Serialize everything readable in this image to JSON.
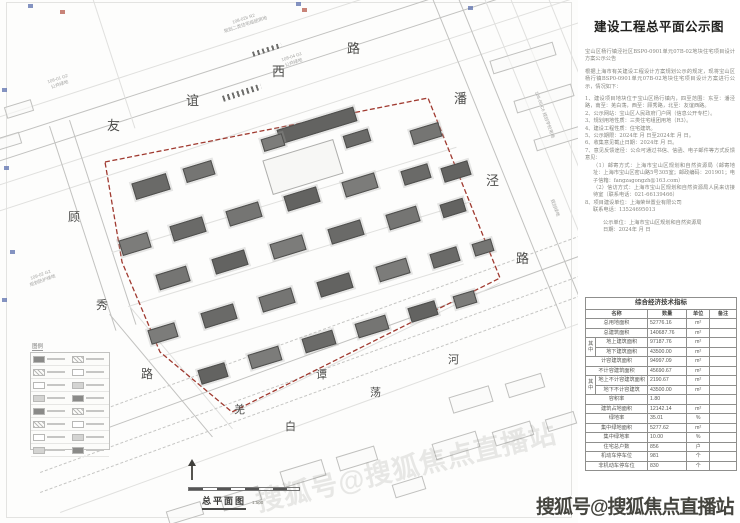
{
  "watermark": {
    "text": "搜狐号@搜狐焦点直播站",
    "ghost_text": "搜狐号@搜狐焦点直播站"
  },
  "panel": {
    "title": "建设工程总平面公示图",
    "paragraphs": [
      {
        "t": "宝山区杨行镇泾社区BSP0-0901单元07B-02地块住宅项目设计方案公示公告",
        "c": "p gap"
      },
      {
        "t": "根据上海市有关建设工程设计方案规划公示的规定，现将宝山区杨行镇BSP0-0901单元07B-02地块住宅项目设计方案进行公示，情况如下：",
        "c": "p gap"
      },
      {
        "t": "1、建设项目地块位于宝山区杨行镇内，四至范围：东至：潘泾路，南至：羌白荡，西至：顾秀路，北至：友谊西路。",
        "c": "p gap"
      },
      {
        "t": "2、公示网站：宝山区人民政府门户网（信息公开专栏）。",
        "c": "p"
      },
      {
        "t": "3、规划用地性质：三类住宅组团用地（R3）。",
        "c": "p"
      },
      {
        "t": "4、建设工程性质：住宅建筑。",
        "c": "p"
      },
      {
        "t": "5、公示期限：2024年 月 日至2024年 月 日。",
        "c": "p"
      },
      {
        "t": "6、收集意见截止日期：2024年 月 日。",
        "c": "p"
      },
      {
        "t": "7、意见反馈途径：公众可通过书信、信函、电子邮件等方式反馈意见：",
        "c": "p"
      },
      {
        "t": "（1）邮寄方式：上海市宝山区规划和自然资源局（邮寄地址：上海市宝山区密山路5号305室；邮政编码：201901；电子信箱：fangzagongzh@163.com）",
        "c": "p ind"
      },
      {
        "t": "（2）信访方式：上海市宝山区规划和自然资源局人民来访接待室（联系电话：021-66139466）",
        "c": "p ind"
      },
      {
        "t": "8、项目建设单位：上海荣世置业有限公司",
        "c": "p"
      },
      {
        "t": "联系电话：13524695013",
        "c": "p ind"
      },
      {
        "t": "公示单位：上海市宝山区规划和自然资源局",
        "c": "p ind2 gap"
      },
      {
        "t": "日期：2024年 月 日",
        "c": "p ind2"
      }
    ],
    "table": {
      "title": "综合经济技术指标",
      "headers": [
        "名称",
        "数量",
        "单位",
        "备注"
      ],
      "group_label": "其中",
      "rows": [
        {
          "name": "总用地面积",
          "value": "52776.16",
          "unit": "m²",
          "note": "",
          "flag": ""
        },
        {
          "name": "总建筑面积",
          "value": "140687.76",
          "unit": "m²",
          "note": "",
          "flag": ""
        },
        {
          "name": "地上建筑面积",
          "value": "97187.76",
          "unit": "m²",
          "note": "",
          "flag": "gs"
        },
        {
          "name": "地下建筑面积",
          "value": "43500.00",
          "unit": "m²",
          "note": "",
          "flag": "gm"
        },
        {
          "name": "计容建筑面积",
          "value": "94997.09",
          "unit": "m²",
          "note": "",
          "flag": ""
        },
        {
          "name": "不计容建筑面积",
          "value": "45690.67",
          "unit": "m²",
          "note": "",
          "flag": ""
        },
        {
          "name": "地上不计容建筑面积",
          "value": "2190.67",
          "unit": "m²",
          "note": "",
          "flag": "gs"
        },
        {
          "name": "地下不计容建筑",
          "value": "43500.00",
          "unit": "m²",
          "note": "",
          "flag": "gm"
        },
        {
          "name": "容积率",
          "value": "1.80",
          "unit": "",
          "note": "",
          "flag": ""
        },
        {
          "name": "建筑占地面积",
          "value": "12142.14",
          "unit": "m²",
          "note": "",
          "flag": ""
        },
        {
          "name": "绿地率",
          "value": "35.01",
          "unit": "%",
          "note": "",
          "flag": ""
        },
        {
          "name": "集中绿地面积",
          "value": "5277.62",
          "unit": "m²",
          "note": "",
          "flag": ""
        },
        {
          "name": "集中绿地率",
          "value": "10.00",
          "unit": "%",
          "note": "",
          "flag": ""
        },
        {
          "name": "住宅总户数",
          "value": "856",
          "unit": "户",
          "note": "",
          "flag": ""
        },
        {
          "name": "机动车停车位",
          "value": "981",
          "unit": "个",
          "note": "",
          "flag": ""
        },
        {
          "name": "非机动车停车位",
          "value": "830",
          "unit": "个",
          "note": "",
          "flag": ""
        }
      ]
    }
  },
  "map": {
    "plan_label": "总平面图",
    "scale_label": "1:500",
    "legend_title": "图例",
    "legend_row_count": 8,
    "boundary_color": "#a03a30",
    "boundary_points": "105,162 428,98 500,278 232,412 160,352 122,262",
    "road_labels": [
      {
        "ch": "友",
        "x": 107,
        "y": 115,
        "s": 13
      },
      {
        "ch": "谊",
        "x": 186,
        "y": 90,
        "s": 13
      },
      {
        "ch": "西",
        "x": 272,
        "y": 61,
        "s": 13
      },
      {
        "ch": "路",
        "x": 347,
        "y": 38,
        "s": 13
      },
      {
        "ch": "潘",
        "x": 454,
        "y": 88,
        "s": 13
      },
      {
        "ch": "泾",
        "x": 486,
        "y": 170,
        "s": 13
      },
      {
        "ch": "路",
        "x": 516,
        "y": 248,
        "s": 13
      },
      {
        "ch": "顾",
        "x": 68,
        "y": 208,
        "s": 12
      },
      {
        "ch": "秀",
        "x": 96,
        "y": 296,
        "s": 12
      },
      {
        "ch": "路",
        "x": 141,
        "y": 365,
        "s": 12
      },
      {
        "ch": "羌",
        "x": 234,
        "y": 401,
        "s": 11
      },
      {
        "ch": "白",
        "x": 285,
        "y": 418,
        "s": 11
      },
      {
        "ch": "谭",
        "x": 316,
        "y": 366,
        "s": 11
      },
      {
        "ch": "荡",
        "x": 370,
        "y": 384,
        "s": 11
      },
      {
        "ch": "河",
        "x": 448,
        "y": 351,
        "s": 11
      }
    ],
    "parcel_labels": [
      {
        "x": 222,
        "y": 16,
        "rot": -18,
        "lines": [
          "108-02b R2",
          "规划二类住宅组团用地"
        ]
      },
      {
        "x": 48,
        "y": 76,
        "rot": -18,
        "lines": [
          "106-01 G2",
          "公共绿地"
        ]
      },
      {
        "x": 282,
        "y": 54,
        "rot": -18,
        "lines": [
          "108-04 G1",
          "公共绿地"
        ]
      },
      {
        "x": 28,
        "y": 272,
        "rot": -20,
        "lines": [
          "109-02 G2",
          "规划防护绿地"
        ]
      },
      {
        "x": 520,
        "y": 112,
        "rot": 70,
        "lines": [
          "108-06 C6 规划学校用地"
        ]
      },
      {
        "x": 546,
        "y": 205,
        "rot": 70,
        "lines": [
          "规划绿地"
        ]
      }
    ],
    "road_lines": [
      [
        -30,
        126,
        660,
        -18,
        "f"
      ],
      [
        -30,
        148,
        660,
        -18,
        "s"
      ],
      [
        -30,
        170,
        660,
        -18,
        "s"
      ],
      [
        -30,
        194,
        660,
        -18,
        "f"
      ],
      [
        -30,
        220,
        660,
        -18,
        "f"
      ],
      [
        50,
        126,
        215,
        72,
        "s"
      ],
      [
        70,
        120,
        215,
        72,
        "s"
      ],
      [
        86,
        -24,
        160,
        72,
        "f"
      ],
      [
        110,
        314,
        160,
        50,
        "s"
      ],
      [
        130,
        306,
        160,
        50,
        "f"
      ],
      [
        424,
        -24,
        380,
        68,
        "s"
      ],
      [
        450,
        -24,
        380,
        68,
        "s"
      ],
      [
        476,
        -24,
        380,
        68,
        "f"
      ],
      [
        502,
        -24,
        360,
        68,
        "f"
      ],
      [
        540,
        -24,
        200,
        68,
        "f"
      ],
      [
        570,
        -24,
        160,
        68,
        "f"
      ],
      [
        40,
        432,
        580,
        -20,
        "d"
      ],
      [
        40,
        452,
        580,
        -20,
        "s"
      ],
      [
        40,
        472,
        580,
        -20,
        "d"
      ],
      [
        40,
        492,
        580,
        -20,
        "d"
      ],
      [
        60,
        512,
        560,
        -20,
        "f"
      ],
      [
        230,
        414,
        300,
        -26,
        "f"
      ],
      [
        112,
        252,
        360,
        -17,
        "f"
      ],
      [
        128,
        306,
        360,
        -17,
        "f"
      ],
      [
        148,
        360,
        330,
        -17,
        "f"
      ]
    ],
    "crosswalks": [
      [
        222,
        96,
        40,
        6,
        -18
      ],
      [
        252,
        52,
        30,
        5,
        -18
      ]
    ],
    "buildings": [
      [
        150,
        185,
        34,
        15
      ],
      [
        198,
        170,
        28,
        13
      ],
      [
        316,
        124,
        78,
        13
      ],
      [
        272,
        141,
        20,
        11
      ],
      [
        356,
        137,
        24,
        11
      ],
      [
        425,
        132,
        28,
        13
      ],
      [
        455,
        170,
        26,
        13
      ],
      [
        134,
        243,
        28,
        14
      ],
      [
        187,
        228,
        32,
        14
      ],
      [
        243,
        213,
        32,
        14
      ],
      [
        301,
        198,
        32,
        14
      ],
      [
        359,
        184,
        32,
        14
      ],
      [
        415,
        173,
        26,
        13
      ],
      [
        172,
        277,
        30,
        14
      ],
      [
        229,
        261,
        32,
        14
      ],
      [
        287,
        246,
        32,
        14
      ],
      [
        345,
        231,
        32,
        14
      ],
      [
        402,
        217,
        30,
        14
      ],
      [
        452,
        207,
        22,
        12
      ],
      [
        162,
        332,
        26,
        13
      ],
      [
        218,
        315,
        32,
        14
      ],
      [
        276,
        299,
        32,
        14
      ],
      [
        334,
        284,
        32,
        14
      ],
      [
        392,
        269,
        30,
        14
      ],
      [
        444,
        256,
        26,
        13
      ],
      [
        482,
        246,
        18,
        11
      ],
      [
        212,
        372,
        26,
        13
      ],
      [
        264,
        356,
        30,
        13
      ],
      [
        318,
        340,
        30,
        13
      ],
      [
        371,
        325,
        30,
        13
      ],
      [
        422,
        310,
        26,
        13
      ],
      [
        464,
        298,
        20,
        11
      ]
    ],
    "courtyard": [
      302,
      166,
      72,
      34
    ],
    "outline_buildings": [
      [
        522,
        57,
        64,
        12
      ],
      [
        543,
        97,
        58,
        11
      ],
      [
        559,
        137,
        50,
        10
      ],
      [
        470,
        398,
        40,
        15
      ],
      [
        524,
        384,
        36,
        13
      ],
      [
        455,
        444,
        44,
        15
      ],
      [
        512,
        432,
        38,
        13
      ],
      [
        560,
        420,
        28,
        11
      ],
      [
        302,
        472,
        42,
        15
      ],
      [
        356,
        457,
        38,
        13
      ],
      [
        240,
        497,
        38,
        13
      ],
      [
        184,
        512,
        34,
        12
      ],
      [
        408,
        486,
        30,
        12
      ],
      [
        18,
        108,
        26,
        10
      ],
      [
        8,
        140,
        22,
        10
      ]
    ],
    "stamps": [
      [
        28,
        4,
        "#5b6fae"
      ],
      [
        296,
        2,
        "#5b6fae"
      ],
      [
        468,
        6,
        "#5b6fae"
      ],
      [
        2,
        88,
        "#5b6fae"
      ],
      [
        4,
        166,
        "#5b6fae"
      ],
      [
        10,
        250,
        "#5b6fae"
      ],
      [
        2,
        298,
        "#5b6fae"
      ],
      [
        60,
        10,
        "#b65a4c"
      ],
      [
        302,
        8,
        "#b65a4c"
      ]
    ]
  }
}
